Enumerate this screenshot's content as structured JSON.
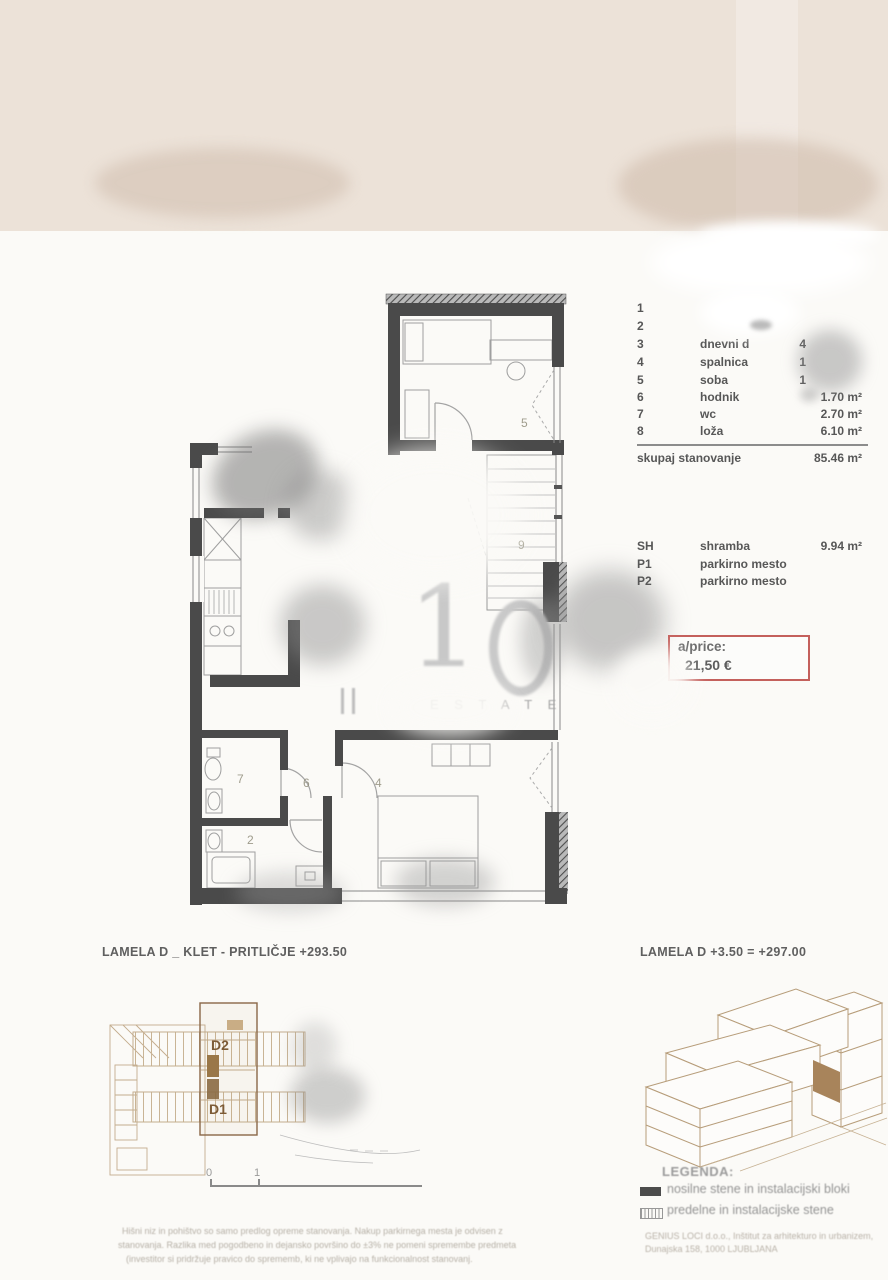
{
  "unit_table": {
    "rows": [
      {
        "no": "1",
        "name": "",
        "area": ""
      },
      {
        "no": "2",
        "name": "",
        "area": ""
      },
      {
        "no": "3",
        "name": "dnevni d",
        "area": "4"
      },
      {
        "no": "4",
        "name": "spalnica",
        "area": "1"
      },
      {
        "no": "5",
        "name": "soba",
        "area": "1"
      },
      {
        "no": "6",
        "name": "hodnik",
        "area": "1.70 m²"
      },
      {
        "no": "7",
        "name": "wc",
        "area": "2.70 m²"
      },
      {
        "no": "8",
        "name": "loža",
        "area": "6.10 m²"
      }
    ],
    "total_label": "skupaj stanovanje",
    "total_area": "85.46 m²"
  },
  "extras": {
    "rows": [
      {
        "code": "SH",
        "name": "shramba",
        "area": "9.94 m²"
      },
      {
        "code": "P1",
        "name": "parkirno mesto",
        "area": ""
      },
      {
        "code": "P2",
        "name": "parkirno mesto",
        "area": ""
      }
    ]
  },
  "price": {
    "label": "a/price:",
    "value": "21,50 €",
    "border_color": "#c4605c"
  },
  "plan": {
    "numbers": {
      "room5": "5",
      "stairs": "9",
      "wc": "7",
      "hall": "6",
      "bath": "2",
      "bedroom": "4"
    },
    "watermark": {
      "big": "1",
      "estate": "E S T A T E"
    }
  },
  "keyplan": {
    "title": "LAMELA D _ KLET - PRITLIČJE +293.50",
    "unit_top": "D2",
    "unit_bottom": "D1",
    "scale0": "0",
    "scale1": "1"
  },
  "axon": {
    "title": "LAMELA D +3.50 = +297.00",
    "highlight_color": "#a8845b"
  },
  "legend": {
    "title": "LEGENDA:",
    "item1": "nosilne stene in instalacijski bloki",
    "item2": "predelne in instalacijske stene"
  },
  "footer": {
    "disclaimer1": "Hišni niz in pohištvo so samo predlog opreme stanovanja. Nakup parkirnega mesta je odvisen z",
    "disclaimer2": "stanovanja. Razlika med pogodbeno in dejansko površino do ±3% ne pomeni spremembe predmeta",
    "disclaimer3": "(investitor si pridržuje pravico do sprememb, ki ne vplivajo na funkcionalnost stanovanj.",
    "company1": "GENIUS LOCI d.o.o., Inštitut za arhitekturo in urbanizem,",
    "company2": "Dunajska 158, 1000 LJUBLJANA"
  }
}
